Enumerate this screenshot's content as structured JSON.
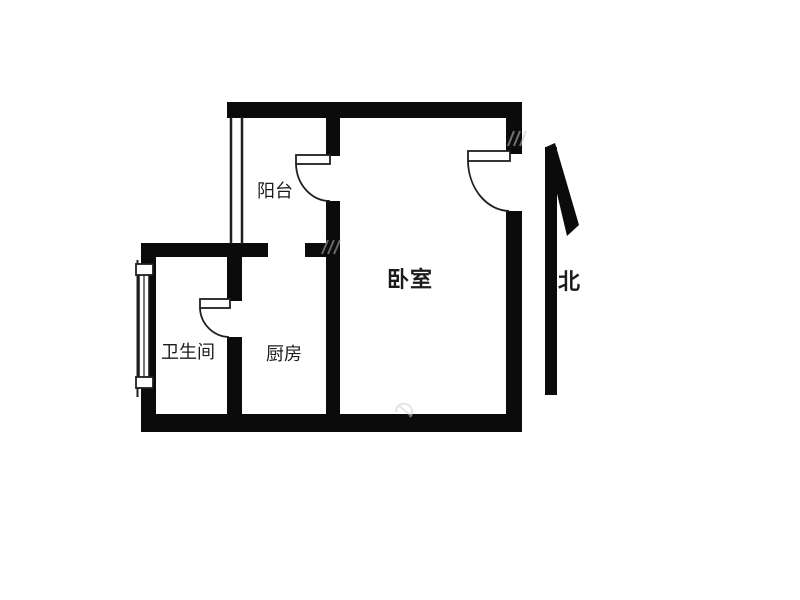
{
  "image": {
    "type": "floor-plan",
    "background": "#ffffff",
    "wall_color": "#0b0b0b",
    "line_color": "#1f1f1f",
    "watermark_color": "#c4c4c4"
  },
  "floorplan": {
    "rooms": [
      {
        "id": "balcony",
        "name": "阳台"
      },
      {
        "id": "bedroom",
        "name": "卧室"
      },
      {
        "id": "bathroom",
        "name": "卫生间"
      },
      {
        "id": "kitchen",
        "name": "厨房"
      }
    ],
    "compass": {
      "label": "北",
      "direction": "north"
    },
    "features": {
      "doors": [
        "balcony-to-bedroom",
        "bathroom",
        "bedroom-entry"
      ],
      "windows": [
        "balcony-left",
        "bathroom-left"
      ]
    }
  }
}
